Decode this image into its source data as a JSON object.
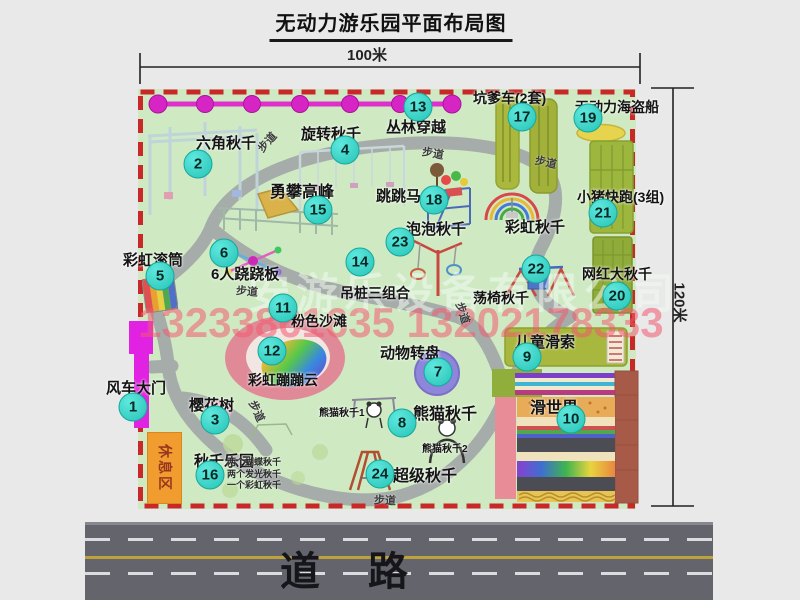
{
  "title": "无动力游乐园平面布局图",
  "dimensions": {
    "width": "100米",
    "height": "120米"
  },
  "road": {
    "label": "道路"
  },
  "watermark": {
    "company": "安游乐设备有限公司",
    "phone": "13233861635 13202178333"
  },
  "rest_area": "休息区",
  "trail_label": "步道",
  "colors": {
    "park_green": "#cfeac3",
    "border_red": "#c82828",
    "badge_teal": "#27c3b7",
    "gate_magenta": "#e222e2",
    "road_gray": "#64646d",
    "rest_orange": "#f09c2e"
  },
  "markers": [
    {
      "num": "1",
      "label": "风车大门",
      "cx": 133,
      "cy": 407,
      "lx": 106,
      "ly": 377,
      "fs": 15
    },
    {
      "num": "2",
      "label": "六角秋千",
      "cx": 198,
      "cy": 164,
      "lx": 196,
      "ly": 132,
      "fs": 15
    },
    {
      "num": "3",
      "label": "樱花树",
      "cx": 215,
      "cy": 420,
      "lx": 189,
      "ly": 394,
      "fs": 15
    },
    {
      "num": "4",
      "label": "旋转秋千",
      "cx": 345,
      "cy": 150,
      "lx": 301,
      "ly": 123,
      "fs": 15
    },
    {
      "num": "5",
      "label": "彩虹滚筒",
      "cx": 160,
      "cy": 276,
      "lx": 123,
      "ly": 249,
      "fs": 15
    },
    {
      "num": "6",
      "label": "6人跷跷板",
      "cx": 224,
      "cy": 253,
      "lx": 211,
      "ly": 263,
      "fs": 15
    },
    {
      "num": "7",
      "label": "动物转盘",
      "cx": 438,
      "cy": 372,
      "lx": 380,
      "ly": 342,
      "fs": 15
    },
    {
      "num": "8",
      "label": "熊猫秋千",
      "cx": 402,
      "cy": 423,
      "lx": 413,
      "ly": 400,
      "fs": 16
    },
    {
      "num": "9",
      "label": "儿童滑索",
      "cx": 527,
      "cy": 357,
      "lx": 515,
      "ly": 331,
      "fs": 15
    },
    {
      "num": "10",
      "label": "滑世界",
      "cx": 571,
      "cy": 419,
      "lx": 530,
      "ly": 394,
      "fs": 16
    },
    {
      "num": "11",
      "label": "粉色沙滩",
      "cx": 283,
      "cy": 308,
      "lx": 291,
      "ly": 311,
      "fs": 14
    },
    {
      "num": "12",
      "label": "彩虹蹦蹦云",
      "cx": 272,
      "cy": 351,
      "lx": 248,
      "ly": 370,
      "fs": 14
    },
    {
      "num": "13",
      "label": "丛林穿越",
      "cx": 418,
      "cy": 107,
      "lx": 386,
      "ly": 116,
      "fs": 15
    },
    {
      "num": "14",
      "label": "吊桩三组合",
      "cx": 360,
      "cy": 262,
      "lx": 340,
      "ly": 283,
      "fs": 14
    },
    {
      "num": "15",
      "label": "勇攀高峰",
      "cx": 318,
      "cy": 210,
      "lx": 270,
      "ly": 178,
      "fs": 16
    },
    {
      "num": "16",
      "label": "秋千乐园",
      "cx": 210,
      "cy": 475,
      "lx": 194,
      "ly": 450,
      "fs": 15
    },
    {
      "num": "17",
      "label": "坑爹车(2套)",
      "cx": 522,
      "cy": 117,
      "lx": 473,
      "ly": 88,
      "fs": 14
    },
    {
      "num": "18",
      "label": "跳跳马",
      "cx": 434,
      "cy": 200,
      "lx": 376,
      "ly": 185,
      "fs": 15
    },
    {
      "num": "19",
      "label": "无动力海盗船",
      "cx": 588,
      "cy": 118,
      "lx": 575,
      "ly": 97,
      "fs": 14
    },
    {
      "num": "20",
      "label": "网红大秋千",
      "cx": 617,
      "cy": 296,
      "lx": 582,
      "ly": 264,
      "fs": 14
    },
    {
      "num": "21",
      "label": "小猪快跑(3组)",
      "cx": 603,
      "cy": 213,
      "lx": 577,
      "ly": 187,
      "fs": 14
    },
    {
      "num": "22",
      "label": "荡椅秋千",
      "cx": 536,
      "cy": 269,
      "lx": 473,
      "ly": 288,
      "fs": 14
    },
    {
      "num": "23",
      "label": "泡泡秋千",
      "cx": 400,
      "cy": 242,
      "lx": 406,
      "ly": 218,
      "fs": 15
    },
    {
      "num": "24",
      "label": "超级秋千",
      "cx": 380,
      "cy": 474,
      "lx": 393,
      "ly": 462,
      "fs": 16
    }
  ],
  "extra_labels": [
    {
      "id": "rainbow-swing",
      "text": "彩虹秋千",
      "x": 505,
      "y": 216,
      "fs": 15
    },
    {
      "id": "panda-swing-1",
      "text": "熊猫秋千1",
      "x": 319,
      "y": 404,
      "fs": 10
    },
    {
      "id": "panda-swing-2",
      "text": "熊猫秋千2",
      "x": 422,
      "y": 440,
      "fs": 10
    }
  ],
  "swing_notes": {
    "x": 227,
    "y": 457,
    "lines": [
      "两个蝴蝶秋千",
      "两个发光秋千",
      "一个彩虹秋千"
    ]
  },
  "trails": [
    {
      "x": 256,
      "y": 134,
      "rot": -48
    },
    {
      "x": 422,
      "y": 145,
      "rot": 10
    },
    {
      "x": 535,
      "y": 154,
      "rot": 12
    },
    {
      "x": 236,
      "y": 283,
      "rot": 5
    },
    {
      "x": 246,
      "y": 403,
      "rot": 65
    },
    {
      "x": 374,
      "y": 492,
      "rot": 3
    },
    {
      "x": 452,
      "y": 305,
      "rot": 72
    }
  ]
}
